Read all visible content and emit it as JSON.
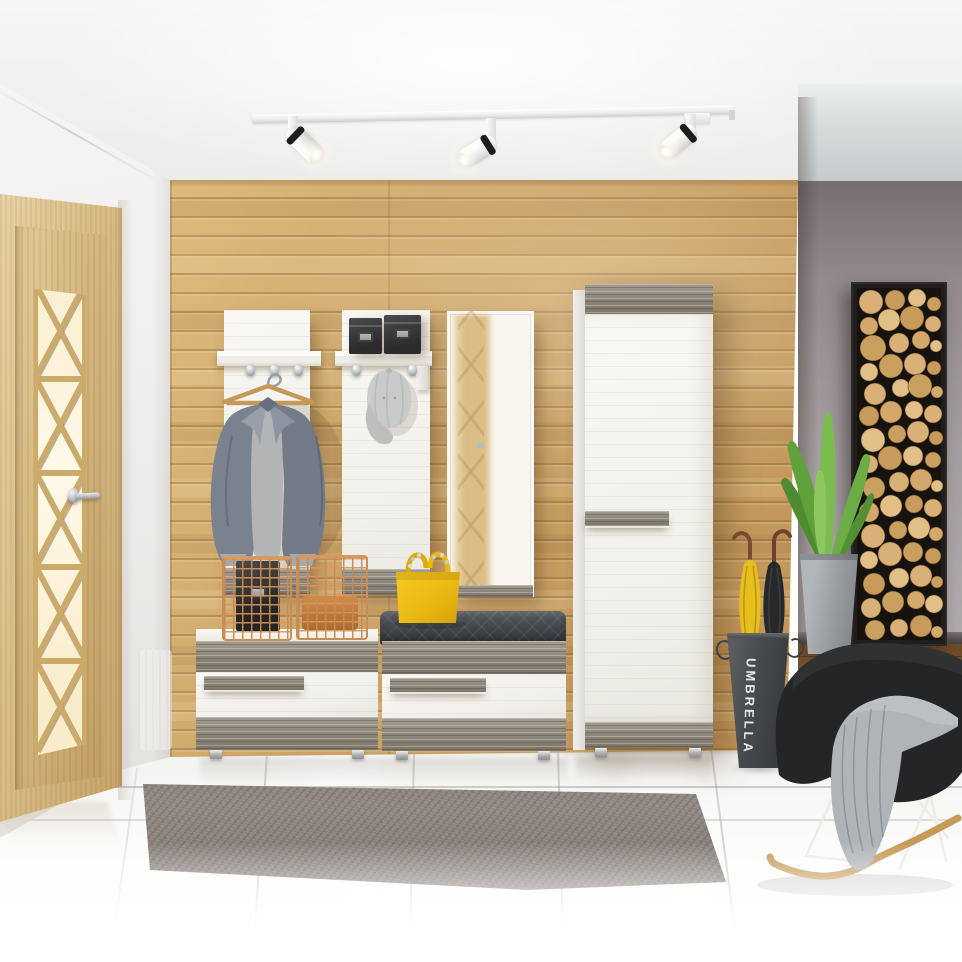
{
  "meta": {
    "type": "interior-3d-render",
    "description": "Photorealistic render of an entryway hallway: oak plank feature wall with white/grey hallway furniture set, glazed oak door, ceiling track spotlights, grey rug on white gloss tile, and a living area to the right with log-slice wall art and a black rocking chair."
  },
  "labels": {
    "umbrella_stand_text": "UMBRELLA"
  },
  "palette": {
    "oak_wall": "#cda468",
    "door_oak": "#d7ba83",
    "furniture_white_pine": "#f2f1ec",
    "furniture_grey_wood": "#8f897d",
    "cushion_grey": "#45484c",
    "accent_yellow": "#eec31c",
    "copper_basket": "#c98e55",
    "right_wall_grey": "#a29b9d",
    "wood_floor_brown": "#855b33",
    "tile_floor_white": "#f6f6f5",
    "rug_grey": "#8b827c",
    "chair_black": "#242628",
    "plant_green": "#67ab41",
    "umbrella_stand_grey": "#46494c",
    "log_art_wood": "#d3aa6e"
  },
  "objects": [
    "white ceiling track with three adjustable spotlights",
    "glazed oak interior door with cross-lattice glass and chrome lever handle",
    "horizontal oak plank feature wall",
    "white coat panel with shelf, three hooks and grey blazer on wooden hanger",
    "white coat panel with shelf, two dark storage boxes and hanging grey cap",
    "frameless wall mirror reflecting the door",
    "tall white pine wardrobe with grey wood top, handle and plinth",
    "low shoe cabinet with two copper wire baskets and black storage box",
    "low shoe bench with grey quilted cushion and yellow handbag",
    "grey shaggy rug on white gloss tile floor",
    "dark grey umbrella stand labelled UMBRELLA holding yellow and black umbrellas",
    "potted green plant in grey tapered planter",
    "vertical log-slice wall art panel on grey wall",
    "black rocking armchair with grey knit throw, white wire base and wooden rockers",
    "dark wood floor of adjoining living area"
  ]
}
